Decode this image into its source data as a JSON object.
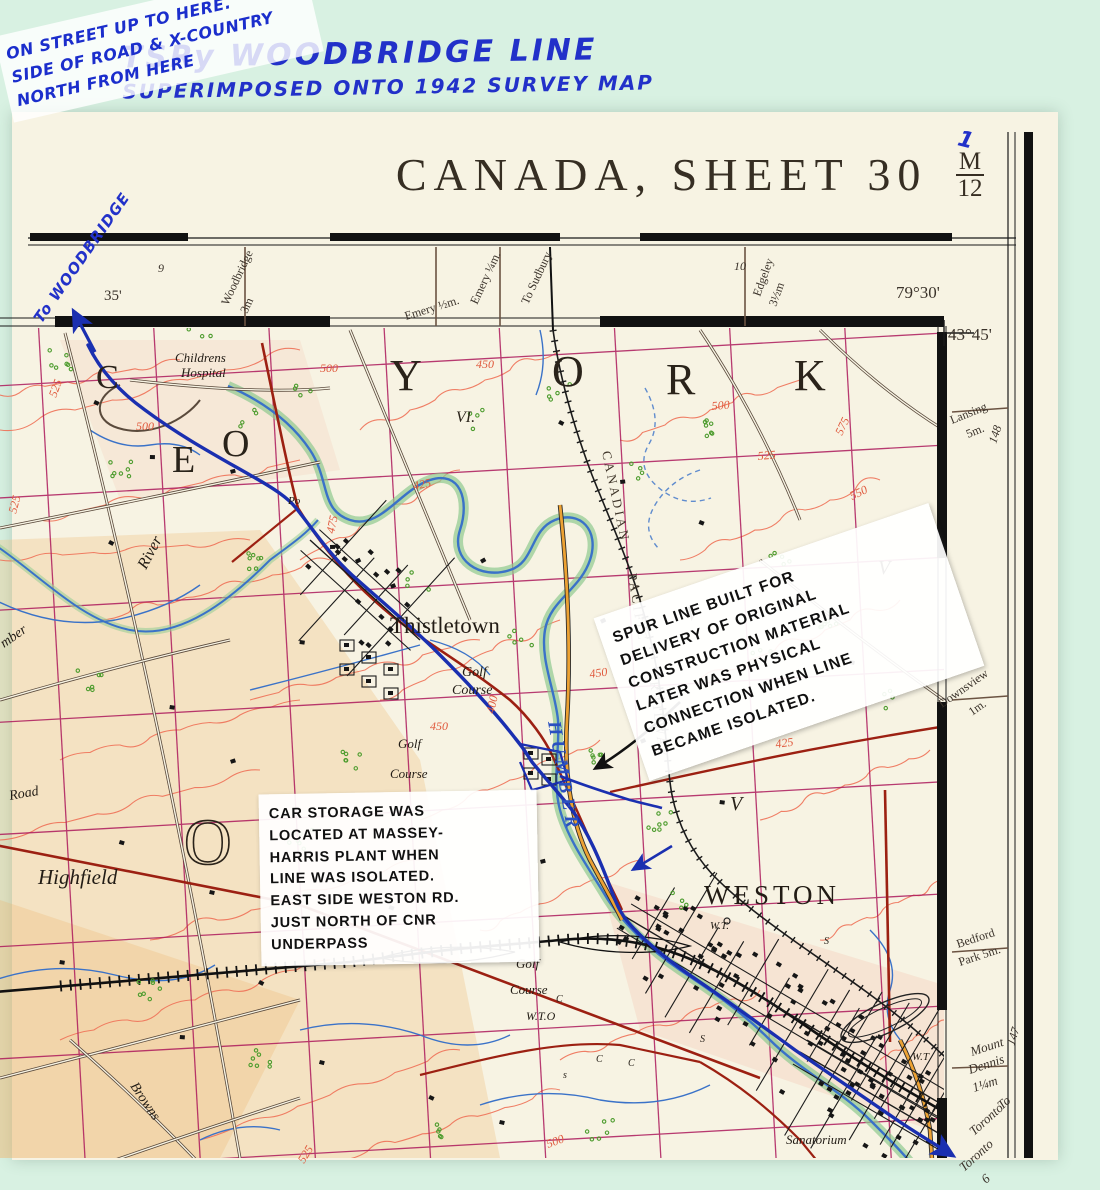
{
  "scan": {
    "handwritten_title_line1": "TSRy WOODBRIDGE LINE",
    "handwritten_title_line2": "SUPERIMPOSED ONTO 1942 SURVEY MAP",
    "stray_mark": "1"
  },
  "sheet": {
    "title": "CANADA, SHEET 30",
    "fraction_numerator": "M",
    "fraction_denominator": "12"
  },
  "annotations": {
    "to_woodbridge": "To WOODBRIDGE",
    "spur_note": "SPUR LINE BUILT FOR\nDELIVERY OF ORIGINAL\nCONSTRUCTION MATERIAL\nLATER WAS PHYSICAL\nCONNECTION WHEN LINE\nBECAME ISOLATED.",
    "car_note": "CAR STORAGE WAS\nLOCATED AT MASSEY-\nHARRIS PLANT WHEN\nLINE WAS ISOLATED.\nEAST SIDE WESTON RD.\nJUST NORTH OF CNR\nUNDERPASS",
    "street_note": "ON STREET UP TO HERE.\nSIDE OF ROAD & X-COUNTRY\nNORTH FROM HERE"
  },
  "colors": {
    "scan_background": "#d8f1e2",
    "paper": "#f7f3e3",
    "grid_magenta": "#ad1a5c",
    "contour_salmon": "#ef7258",
    "water_blue": "#3a72c8",
    "tsry_blue": "#1a2fb0",
    "road_red": "#9c2012",
    "road_orange": "#eda233",
    "handwriting_blue": "#2231c9"
  },
  "map_labels": {
    "labels": [
      {
        "t": "9",
        "x": 158,
        "y": 272,
        "s": 12,
        "c": "mg",
        "i": 1
      },
      {
        "t": "35'",
        "x": 104,
        "y": 300,
        "s": 15,
        "c": "mg"
      },
      {
        "t": "Woodbridge",
        "x": 228,
        "y": 306,
        "r": -65,
        "s": 12,
        "c": "mg"
      },
      {
        "t": "3m",
        "x": 247,
        "y": 314,
        "r": -65,
        "s": 12,
        "c": "mg"
      },
      {
        "t": "Emery ½m.",
        "x": 406,
        "y": 320,
        "r": -17,
        "s": 12,
        "c": "mg"
      },
      {
        "t": "Emery ¼m.",
        "x": 477,
        "y": 305,
        "r": -65,
        "s": 12,
        "c": "mg"
      },
      {
        "t": "To Sudbury",
        "x": 528,
        "y": 305,
        "r": -65,
        "s": 12,
        "c": "mg"
      },
      {
        "t": "10",
        "x": 734,
        "y": 270,
        "s": 12,
        "c": "mg",
        "i": 1
      },
      {
        "t": "Edgeley",
        "x": 760,
        "y": 297,
        "r": -70,
        "s": 12,
        "c": "mg"
      },
      {
        "t": "3½m",
        "x": 776,
        "y": 307,
        "r": -70,
        "s": 12,
        "c": "mg"
      },
      {
        "t": "79°30'",
        "x": 896,
        "y": 298,
        "s": 17,
        "c": "mg"
      },
      {
        "t": "43°45'",
        "x": 948,
        "y": 340,
        "s": 17,
        "c": "mg"
      },
      {
        "t": "Lansing",
        "x": 952,
        "y": 424,
        "r": -22,
        "s": 12,
        "c": "mg"
      },
      {
        "t": "5m.",
        "x": 968,
        "y": 438,
        "r": -22,
        "s": 12,
        "c": "mg"
      },
      {
        "t": "148",
        "x": 996,
        "y": 444,
        "r": -72,
        "s": 12,
        "c": "mg",
        "i": 1
      },
      {
        "t": "Downsview",
        "x": 942,
        "y": 708,
        "r": -35,
        "s": 12,
        "c": "mg"
      },
      {
        "t": "1m.",
        "x": 972,
        "y": 716,
        "r": -35,
        "s": 12,
        "c": "mg"
      },
      {
        "t": "Bedford",
        "x": 958,
        "y": 948,
        "r": -18,
        "s": 12,
        "c": "mg"
      },
      {
        "t": "Park 5m.",
        "x": 960,
        "y": 966,
        "r": -18,
        "s": 12,
        "c": "mg"
      },
      {
        "t": "147",
        "x": 1014,
        "y": 1046,
        "r": -72,
        "s": 12,
        "c": "mg",
        "i": 1
      },
      {
        "t": "Mount",
        "x": 972,
        "y": 1056,
        "r": -18,
        "s": 13,
        "c": "mg",
        "i": 1
      },
      {
        "t": "Dennis",
        "x": 970,
        "y": 1074,
        "r": -18,
        "s": 13,
        "c": "mg",
        "i": 1
      },
      {
        "t": "1¼m",
        "x": 974,
        "y": 1092,
        "r": -18,
        "s": 13,
        "c": "mg",
        "i": 1
      },
      {
        "t": "To",
        "x": 1002,
        "y": 1110,
        "r": -42,
        "s": 13,
        "c": "mg",
        "i": 1
      },
      {
        "t": "Toronto",
        "x": 974,
        "y": 1136,
        "r": -42,
        "s": 13,
        "c": "mg",
        "i": 1
      },
      {
        "t": "Toronto",
        "x": 964,
        "y": 1172,
        "r": -42,
        "s": 13,
        "c": "mg",
        "i": 1
      },
      {
        "t": "6",
        "x": 986,
        "y": 1184,
        "r": -42,
        "s": 13,
        "c": "mg",
        "i": 1
      },
      {
        "t": "Childrens",
        "x": 175,
        "y": 362,
        "s": 13,
        "c": "f",
        "i": 1
      },
      {
        "t": "Hospital",
        "x": 181,
        "y": 377,
        "s": 13,
        "c": "f",
        "i": 1
      },
      {
        "t": "Thistletown",
        "x": 390,
        "y": 633,
        "s": 23,
        "c": "f"
      },
      {
        "t": "WESTON",
        "x": 704,
        "y": 904,
        "s": 27,
        "c": "f",
        "ls": 4
      },
      {
        "t": "Highfield",
        "x": 38,
        "y": 884,
        "s": 21,
        "c": "f",
        "i": 1
      },
      {
        "t": "Golf",
        "x": 462,
        "y": 676,
        "s": 14,
        "c": "f",
        "i": 1
      },
      {
        "t": "Course",
        "x": 452,
        "y": 694,
        "s": 14,
        "c": "f",
        "i": 1
      },
      {
        "t": "Golf",
        "x": 398,
        "y": 748,
        "s": 13,
        "c": "f",
        "i": 1
      },
      {
        "t": "Course",
        "x": 390,
        "y": 778,
        "s": 13,
        "c": "f",
        "i": 1
      },
      {
        "t": "Golf",
        "x": 516,
        "y": 968,
        "s": 13,
        "c": "f",
        "i": 1
      },
      {
        "t": "Course",
        "x": 510,
        "y": 994,
        "s": 13,
        "c": "f",
        "i": 1
      },
      {
        "t": "W.T.O",
        "x": 526,
        "y": 1020,
        "s": 12,
        "c": "f",
        "i": 1
      },
      {
        "t": "W.T.",
        "x": 710,
        "y": 929,
        "s": 11,
        "c": "f",
        "i": 1
      },
      {
        "t": "W.T",
        "x": 912,
        "y": 1060,
        "s": 11,
        "c": "f",
        "i": 1
      },
      {
        "t": "Sanatorium",
        "x": 786,
        "y": 1144,
        "s": 13,
        "c": "f",
        "i": 1
      },
      {
        "t": "Browns",
        "x": 130,
        "y": 1086,
        "s": 14,
        "c": "f",
        "i": 1,
        "r": 56
      },
      {
        "t": "River",
        "x": 146,
        "y": 570,
        "s": 16,
        "c": "f",
        "i": 1,
        "r": -62
      },
      {
        "t": "mber",
        "x": 4,
        "y": 648,
        "s": 14,
        "c": "f",
        "i": 1,
        "r": -35
      },
      {
        "t": "Road",
        "x": 10,
        "y": 800,
        "s": 14,
        "c": "f",
        "i": 1,
        "r": -10
      },
      {
        "t": "Po",
        "x": 288,
        "y": 504,
        "s": 11,
        "c": "f",
        "i": 1
      },
      {
        "t": "S",
        "x": 824,
        "y": 944,
        "s": 10,
        "c": "f",
        "i": 1
      },
      {
        "t": "S",
        "x": 700,
        "y": 1042,
        "s": 10,
        "c": "f",
        "i": 1
      },
      {
        "t": "s",
        "x": 563,
        "y": 1078,
        "s": 10,
        "c": "f",
        "i": 1
      },
      {
        "t": "C",
        "x": 596,
        "y": 1062,
        "s": 10,
        "c": "f",
        "i": 1
      },
      {
        "t": "C",
        "x": 628,
        "y": 1066,
        "s": 10,
        "c": "f",
        "i": 1
      },
      {
        "t": "C",
        "x": 556,
        "y": 1002,
        "s": 10,
        "c": "f",
        "i": 1
      },
      {
        "t": "C",
        "x": 96,
        "y": 388,
        "s": 34,
        "c": "big"
      },
      {
        "t": "E",
        "x": 172,
        "y": 472,
        "s": 38,
        "c": "big"
      },
      {
        "t": "O",
        "x": 222,
        "y": 456,
        "s": 38,
        "c": "big"
      },
      {
        "t": "Y",
        "x": 390,
        "y": 390,
        "s": 44,
        "c": "big"
      },
      {
        "t": "O",
        "x": 552,
        "y": 386,
        "s": 44,
        "c": "big"
      },
      {
        "t": "R",
        "x": 666,
        "y": 394,
        "s": 44,
        "c": "big"
      },
      {
        "t": "K",
        "x": 794,
        "y": 390,
        "s": 44,
        "c": "big"
      },
      {
        "t": "O",
        "x": 184,
        "y": 864,
        "s": 66,
        "c": "bigo"
      },
      {
        "t": "VI.",
        "x": 456,
        "y": 422,
        "s": 16,
        "c": "rn"
      },
      {
        "t": "V",
        "x": 686,
        "y": 620,
        "s": 20,
        "c": "rn"
      },
      {
        "t": "V",
        "x": 730,
        "y": 810,
        "s": 20,
        "c": "rn"
      },
      {
        "t": "V",
        "x": 878,
        "y": 574,
        "s": 20,
        "c": "rn"
      },
      {
        "t": "CANADIAN",
        "x": 602,
        "y": 452,
        "r": 78,
        "ls": 3,
        "s": 13,
        "c": "rail"
      },
      {
        "t": "PACIFIC",
        "x": 628,
        "y": 574,
        "r": 81,
        "ls": 3,
        "s": 13,
        "c": "rail"
      },
      {
        "t": "RAILWAY",
        "x": 650,
        "y": 682,
        "r": 83,
        "ls": 3,
        "s": 13,
        "c": "rail"
      },
      {
        "t": "HUMBER",
        "x": 548,
        "y": 722,
        "r": 80,
        "ls": 5,
        "s": 19,
        "c": "w"
      },
      {
        "t": "525",
        "x": 56,
        "y": 398,
        "r": -70,
        "c": "ct"
      },
      {
        "t": "500",
        "x": 136,
        "y": 430,
        "c": "ct"
      },
      {
        "t": "500",
        "x": 320,
        "y": 372,
        "c": "ct"
      },
      {
        "t": "450",
        "x": 476,
        "y": 368,
        "c": "ct"
      },
      {
        "t": "475",
        "x": 334,
        "y": 534,
        "r": -78,
        "c": "ct"
      },
      {
        "t": "425",
        "x": 414,
        "y": 490,
        "r": -12,
        "c": "ct"
      },
      {
        "t": "400",
        "x": 494,
        "y": 714,
        "r": -78,
        "c": "ct"
      },
      {
        "t": "450",
        "x": 590,
        "y": 678,
        "r": -8,
        "c": "ct"
      },
      {
        "t": "450",
        "x": 430,
        "y": 730,
        "c": "ct"
      },
      {
        "t": "425",
        "x": 776,
        "y": 748,
        "r": -8,
        "c": "ct"
      },
      {
        "t": "500",
        "x": 712,
        "y": 410,
        "r": -5,
        "c": "ct"
      },
      {
        "t": "525",
        "x": 758,
        "y": 460,
        "r": -5,
        "c": "ct"
      },
      {
        "t": "575",
        "x": 842,
        "y": 436,
        "r": -65,
        "c": "ct"
      },
      {
        "t": "550",
        "x": 852,
        "y": 500,
        "r": -25,
        "c": "ct"
      },
      {
        "t": "500",
        "x": 548,
        "y": 1148,
        "r": -20,
        "c": "ct"
      },
      {
        "t": "525",
        "x": 304,
        "y": 1164,
        "r": -58,
        "c": "ct"
      },
      {
        "t": "525",
        "x": 16,
        "y": 514,
        "r": -75,
        "c": "ct"
      }
    ]
  }
}
